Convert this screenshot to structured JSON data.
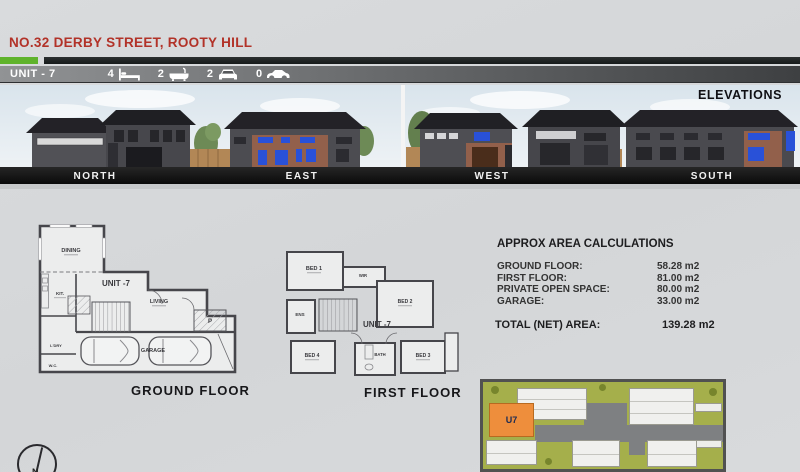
{
  "header": {
    "title": "NO.32 DERBY STREET, ROOTY HILL",
    "title_color": "#b23228"
  },
  "unit_bar": {
    "label": "UNIT - 7",
    "stats": [
      {
        "count": "4",
        "icon": "bed-icon"
      },
      {
        "count": "2",
        "icon": "bath-icon"
      },
      {
        "count": "2",
        "icon": "car-front-icon"
      },
      {
        "count": "0",
        "icon": "car-side-icon"
      }
    ]
  },
  "elevations": {
    "heading": "ELEVATIONS",
    "labels": [
      "NORTH",
      "EAST",
      "WEST",
      "SOUTH"
    ]
  },
  "ground_floor": {
    "caption": "GROUND FLOOR",
    "unit_label": "UNIT -7",
    "rooms": {
      "dining": "DINING",
      "kitchen": "KIT.",
      "living": "LIVING",
      "garage": "GARAGE",
      "laundry": "L'DRY",
      "wc": "W.C.",
      "porch": "P"
    }
  },
  "first_floor": {
    "caption": "FIRST FLOOR",
    "unit_label": "UNIT -7",
    "rooms": {
      "bed1": "BED 1",
      "wir": "WIR",
      "bed2": "BED 2",
      "ens": "ENS",
      "bed4": "BED 4",
      "bath": "BATH",
      "bed3": "BED 3"
    }
  },
  "area_calculations": {
    "heading": "APPROX AREA CALCULATIONS",
    "rows": [
      {
        "label": "GROUND FLOOR:",
        "value": "58.28 m2"
      },
      {
        "label": "FIRST FLOOR:",
        "value": "81.00 m2"
      },
      {
        "label": "PRIVATE OPEN SPACE:",
        "value": "80.00 m2"
      },
      {
        "label": "GARAGE:",
        "value": "33.00 m2"
      }
    ],
    "total": {
      "label": "TOTAL (NET) AREA:",
      "value": "139.28 m2"
    }
  },
  "site_plan": {
    "highlight": "U7",
    "highlight_color": "#ee8e3c",
    "grass_color": "#a5af4b",
    "driveway_color": "#7e8082"
  },
  "compass": {
    "label": "N"
  },
  "colors": {
    "green_bar": "#5fb32b",
    "black_bar": "#1d2121",
    "brick": "#92604b",
    "window_blue": "#2951d8"
  }
}
